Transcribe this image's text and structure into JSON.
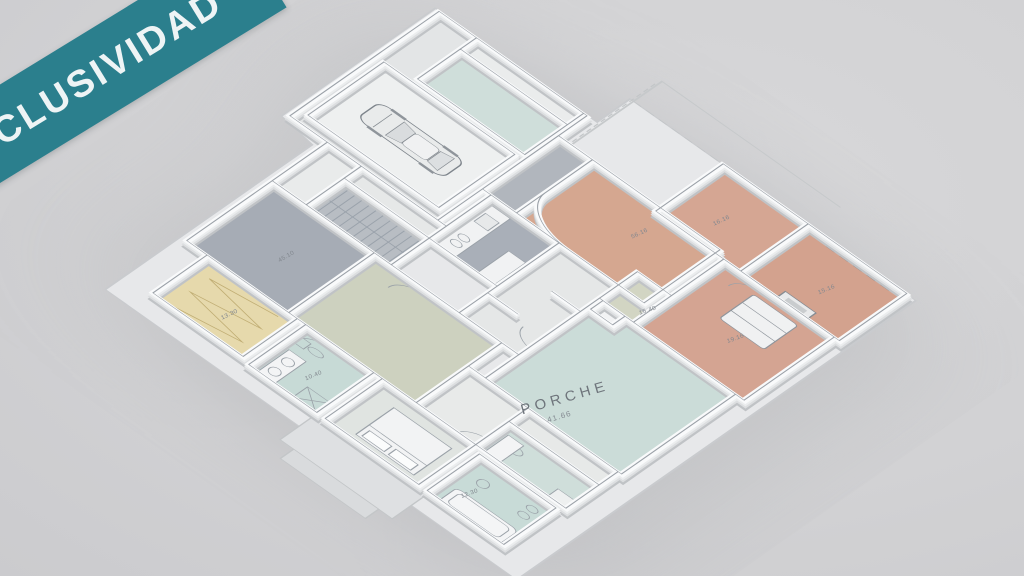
{
  "banner": {
    "label": "EXCLUSIVIDAD",
    "background_color": "#2b7f8d",
    "text_color": "#eef4f5"
  },
  "scene": {
    "description": "isometric 3D floor plan render of a single-storey villa with garage, car, porch and colored room floors",
    "background_color": "#d2d2d4",
    "wall_color": "#f9fafb"
  },
  "plan": {
    "porch": {
      "label": "PORCHE",
      "area": "41.66"
    },
    "area_labels": [
      {
        "room": "storage-nw",
        "text": "45.10"
      },
      {
        "room": "dressing-room",
        "text": "13.30"
      },
      {
        "room": "bathroom-west",
        "text": "10.40"
      },
      {
        "room": "bathroom-sw",
        "text": "12.30"
      },
      {
        "room": "living-room",
        "text": "56.16"
      },
      {
        "room": "bedroom-ne",
        "text": "16.16"
      },
      {
        "room": "bedroom-east",
        "text": "15.16"
      },
      {
        "room": "bedroom-se",
        "text": "19.16"
      },
      {
        "room": "anteroom-sage",
        "text": "15.40"
      }
    ],
    "room_colors": {
      "terracotta_bedrooms_living": "#d4a492",
      "porch_teal": "#cbdcd8",
      "bath_teal": "#c7dad6",
      "utility_teal": "#cfdeda",
      "kitchen_gray": "#a9afb8",
      "storage_gray": "#a6acb5",
      "hall_olive": "#cdd1bf",
      "anteroom_sage": "#d2d5c3",
      "dressing_cream": "#e6d9ac",
      "slab_white": "#e7e8ea"
    }
  }
}
